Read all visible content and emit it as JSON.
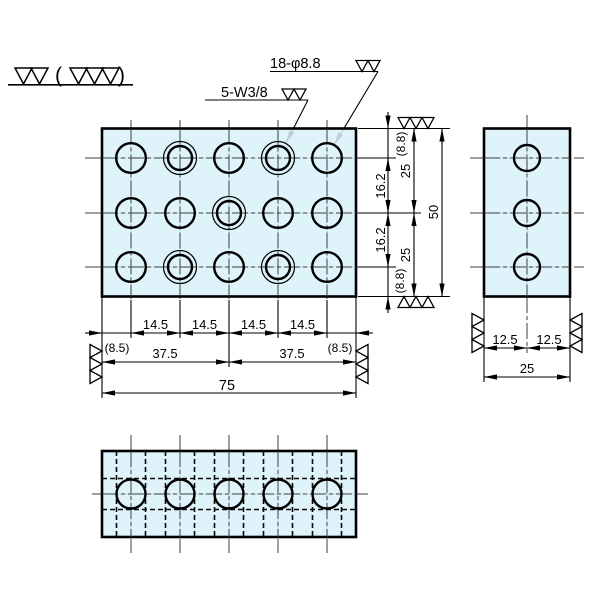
{
  "colors": {
    "plate_fill": "#d8f1f9",
    "background": "#ffffff",
    "line": "#000000"
  },
  "surface_note": {
    "open": "(",
    "close": ")"
  },
  "callouts": {
    "holes": "18-φ8.8",
    "threads": "5-W3/8"
  },
  "front_dims": {
    "pitches": [
      "14.5",
      "14.5",
      "14.5",
      "14.5"
    ],
    "edge_left": "(8.5)",
    "edge_right": "(8.5)",
    "halves": [
      "37.5",
      "37.5"
    ],
    "total_width": "75",
    "edge_top": "(8.8)",
    "edge_bottom": "(8.8)",
    "row_pitches": [
      "16.2",
      "16.2"
    ],
    "height_halves": [
      "25",
      "25"
    ],
    "total_height": "50"
  },
  "side_dims": {
    "halves": [
      "12.5",
      "12.5"
    ],
    "total": "25"
  }
}
